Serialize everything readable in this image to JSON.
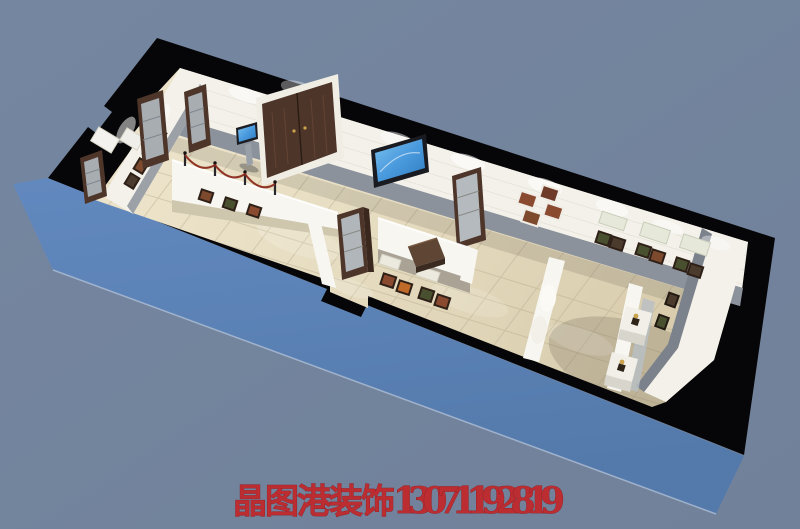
{
  "image_type": "3d-interior-rendering",
  "subject": "exhibition-hall-museum-aerial-oblique-view",
  "watermark": {
    "brand": "晶图港装饰",
    "phone": "13071192819",
    "color": "#c2272b"
  },
  "palette": {
    "background": "#74849d",
    "slab_blue": "#5e84ba",
    "slab_blue_dark": "#547aab",
    "wall_black": "#060608",
    "wall_white": "#f3f1ea",
    "wainscot_gray": "#8c929b",
    "end_wainscot": "#7c828c",
    "floor_light": "#eee5cd",
    "floor_dark": "#d9cdae",
    "partition_white": "#f7f6f1",
    "partition_base": "#a9a295",
    "wood_dark": "#4d352a",
    "wood_mid": "#5f4634",
    "glass_blue": "#c3cdd3",
    "screen_blue": "#4a9ade",
    "rope_red": "#8b2a1e",
    "plaque_green": "#e6e9da",
    "pedestal_white": "#f1efe8",
    "artifact_gold": "#caa34a",
    "watermark_red": "#c2272b"
  },
  "scene": {
    "structure": [
      "thick-black-plan-walls",
      "bright-blue-slab-sides",
      "beige-tiled-floor",
      "white-walls-with-gray-wainscot",
      "chamfered-east-corner"
    ],
    "furnishings": [
      "double-wood-entry-door",
      "touchscreen-info-kiosk",
      "wall-mounted-tv",
      "glass-display-cabinet-west-1",
      "glass-display-cabinet-west-2",
      "glass-display-cabinet-west-3",
      "glass-display-cabinet-backwall",
      "glass-display-tower-center",
      "zigzag-partition-walls",
      "rope-queue-barrier",
      "photo-exhibit-frames",
      "text-plaques",
      "dark-wood-console-table",
      "arched-niche-partition",
      "artifact-pedestal-1",
      "artifact-pedestal-2",
      "glass-case-row"
    ],
    "photo_frame_count": 30,
    "plaque_count": 6,
    "rope_post_count": 4,
    "lighting": "recessed-spotlight-washes-on-walls"
  }
}
